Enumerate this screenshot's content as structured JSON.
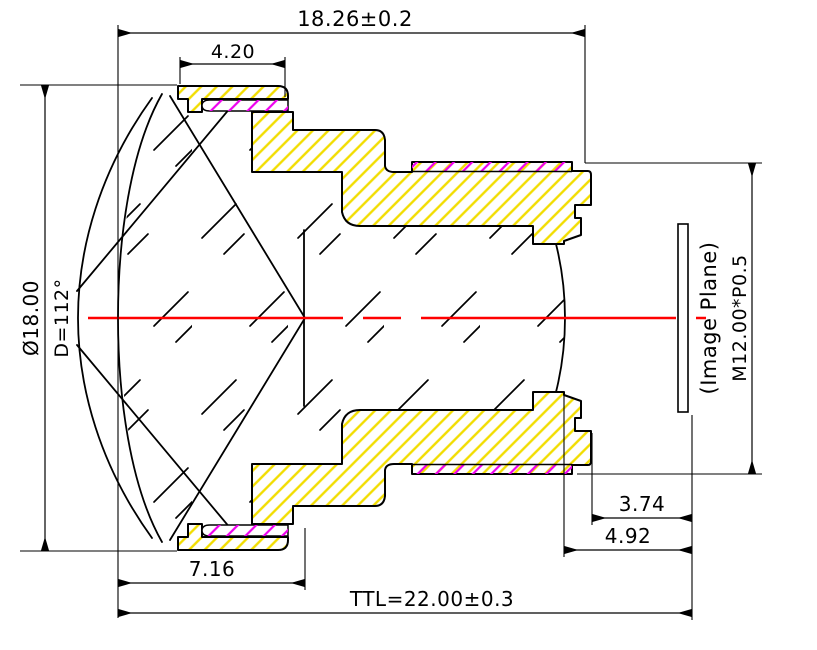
{
  "drawing": {
    "kind": "lens cross-section mechanical drawing",
    "colors": {
      "housing_hatch": "#f2dd00",
      "thread_hatch": "#ee00ee",
      "optical_axis": "#ff0000",
      "outline": "#000000",
      "background": "#ffffff"
    },
    "labels": {
      "top_length": "18.26±0.2",
      "cap_width": "4.20",
      "outer_diameter": "Ø18.00",
      "fov_diameter": "D=112°",
      "back_focal": "3.74",
      "flange_focal": "4.92",
      "front_group_thickness": "7.16",
      "total_track": "TTL=22.00±0.3",
      "image_plane": "(Image Plane)",
      "mount_thread": "M12.00*P0.5"
    }
  }
}
